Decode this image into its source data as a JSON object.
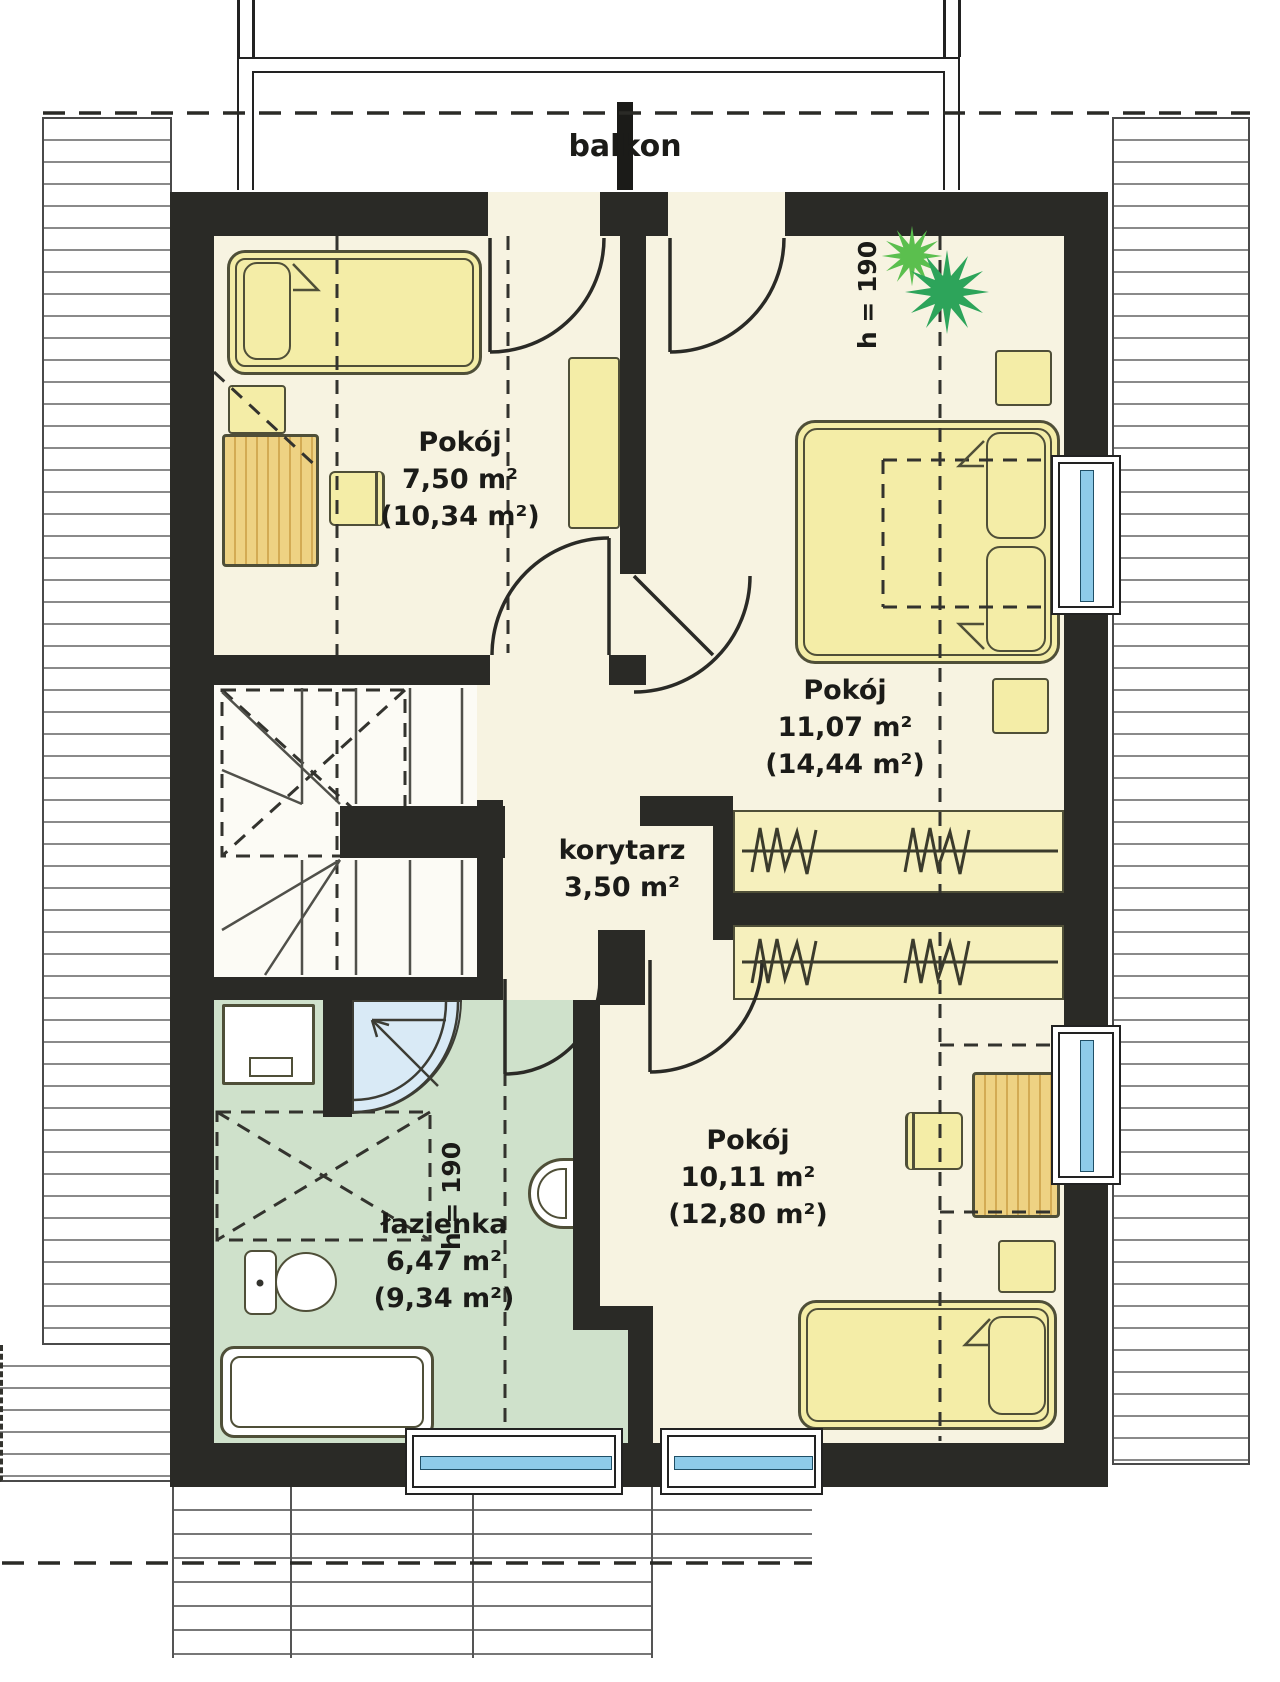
{
  "balcony": {
    "label": "balkon"
  },
  "rooms": {
    "room_top_left": {
      "name": "Pokój",
      "area": "7,50 m²",
      "area_gross": "(10,34 m²)"
    },
    "room_top_right": {
      "name": "Pokój",
      "area": "11,07 m²",
      "area_gross": "(14,44 m²)"
    },
    "corridor": {
      "name": "korytarz",
      "area": "3,50 m²"
    },
    "bathroom": {
      "name": "łazienka",
      "area": "6,47 m²",
      "area_gross": "(9,34 m²)"
    },
    "room_bottom_right": {
      "name": "Pokój",
      "area": "10,11 m²",
      "area_gross": "(12,80 m²)"
    }
  },
  "annotations": {
    "ceiling_height_right": "h = 190",
    "ceiling_height_bath": "h = 190"
  },
  "colors": {
    "wall": "#2a2a26",
    "floor": "#f7f3e1",
    "bathroom_floor": "#cfe1cb",
    "furniture": "#f4eda7",
    "wood": "#eed283",
    "glazing": "#8ecbe9",
    "plant": "#2da45a",
    "shower": "#d9eaf6"
  }
}
